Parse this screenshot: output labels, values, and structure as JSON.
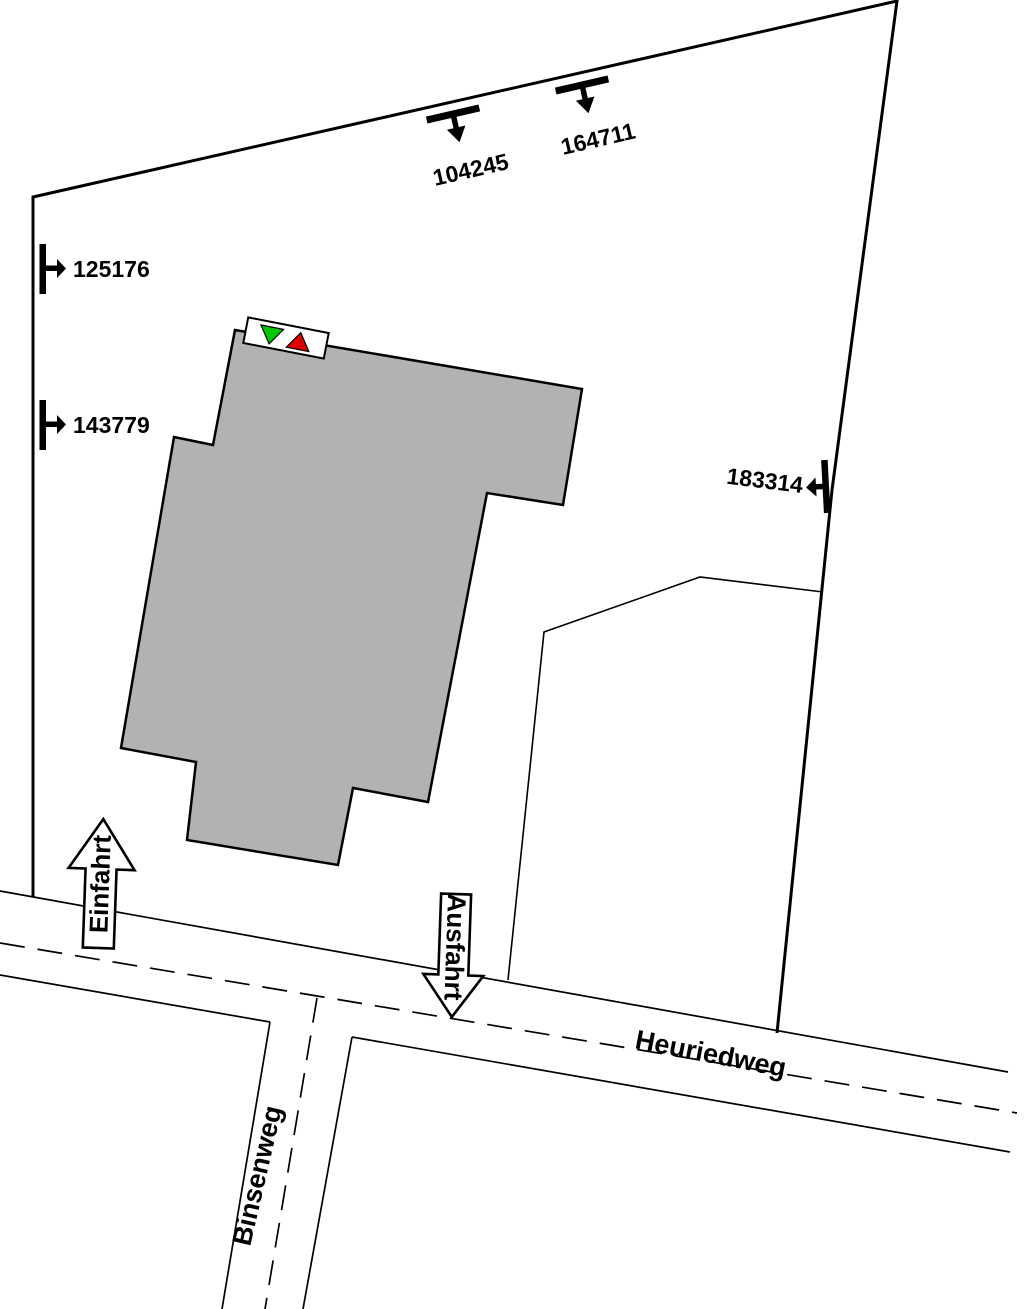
{
  "plan_type": "site-plan",
  "streets": {
    "main": {
      "name": "Heuriedweg"
    },
    "side": {
      "name": "Binsenweg"
    }
  },
  "access": {
    "entrance": {
      "label": "Einfahrt"
    },
    "exit": {
      "label": "Ausfahrt"
    }
  },
  "boundary_points": [
    {
      "id": "104245",
      "symbol": "t-bar-arrow-down"
    },
    {
      "id": "164711",
      "symbol": "t-bar-arrow-down"
    },
    {
      "id": "125176",
      "symbol": "t-bar-arrow-right"
    },
    {
      "id": "143779",
      "symbol": "t-bar-arrow-right"
    },
    {
      "id": "183314",
      "symbol": "t-bar-arrow-left"
    }
  ],
  "building_marker": {
    "green": "#00c800",
    "red": "#dd0000"
  },
  "colors": {
    "building_fill": "#b2b2b2",
    "outline": "#000000",
    "background": "#ffffff"
  }
}
